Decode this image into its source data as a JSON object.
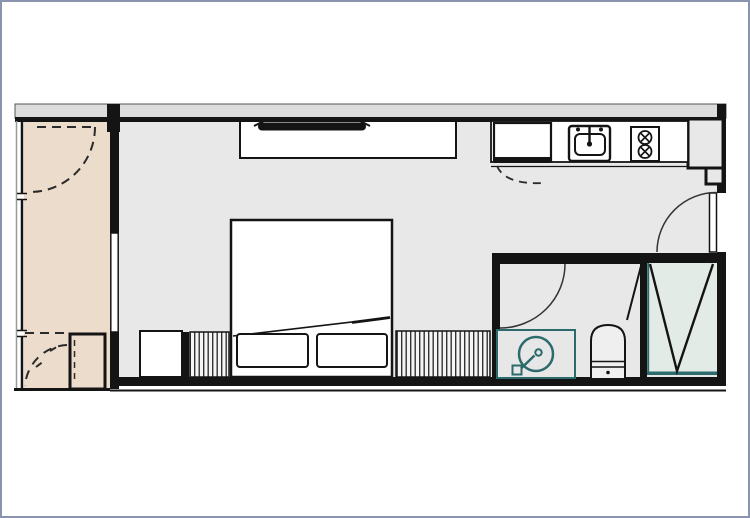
{
  "window": {
    "width": 750,
    "height": 518,
    "border_color": "#8b94ae",
    "background": "#ffffff"
  },
  "floorplan": {
    "type": "studio-apartment-floor-plan",
    "colors": {
      "wall": "#141414",
      "wall_band_fill": "#dcdcdc",
      "room_floor": "#e8e8e8",
      "balcony_floor": "#ecdccb",
      "shower_floor": "#e2ebe6",
      "fixture_accent_teal": "#2c6b6b",
      "furniture_fill": "#ffffff",
      "door_arc": "#333333",
      "toilet_fill": "#efefef"
    },
    "rooms": [
      {
        "name": "balcony",
        "floor": "#ecdccb"
      },
      {
        "name": "main-room",
        "floor": "#e8e8e8"
      },
      {
        "name": "kitchen",
        "floor": "#ffffff"
      },
      {
        "name": "bathroom",
        "floor": "#e8e8e8"
      },
      {
        "name": "shower",
        "floor": "#e2ebe6"
      }
    ],
    "fixtures": [
      "balcony-windows",
      "balcony-door-swing-dashed",
      "ac-unit",
      "balcony-glass-door",
      "tv-console",
      "tv",
      "refrigerator",
      "kitchen-sink",
      "stove-2-burner",
      "kitchen-counter",
      "entry-door",
      "wall-niche",
      "bed",
      "pillow",
      "pillow",
      "blanket-fold-line",
      "wardrobe-hatched",
      "wardrobe-hatched",
      "cabinet",
      "bathroom-door",
      "vanity-counter",
      "round-basin",
      "toilet",
      "shower-partition",
      "shower-door",
      "shower-v-symbol",
      "shower-glass-teal"
    ]
  }
}
